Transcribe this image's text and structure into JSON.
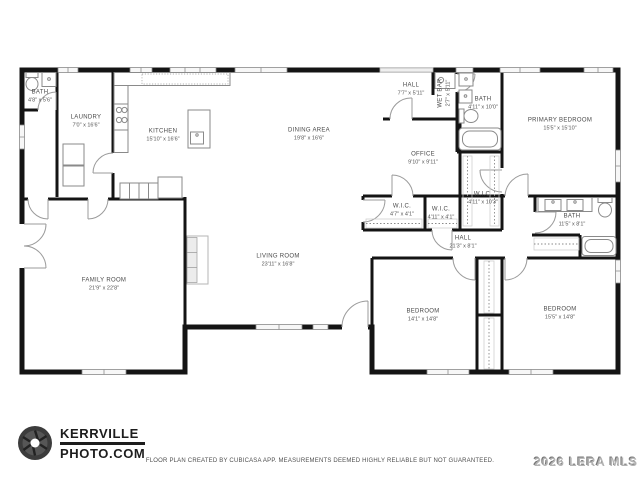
{
  "rooms": {
    "bath_entry": {
      "name": "BATH",
      "dims": "4'8\" x 5'6\""
    },
    "laundry": {
      "name": "LAUNDRY",
      "dims": "7'0\" x 16'6\""
    },
    "kitchen": {
      "name": "KITCHEN",
      "dims": "15'10\" x 16'6\""
    },
    "dining": {
      "name": "DINING AREA",
      "dims": "19'8\" x 16'6\""
    },
    "hall_upper": {
      "name": "HALL",
      "dims": "7'7\" x 5'11\""
    },
    "wet_bar": {
      "name": "WET BAR",
      "dims": "2'7\" x 5'11\""
    },
    "bath_primary": {
      "name": "BATH",
      "dims": "4'11\" x 10'0\""
    },
    "primary_bedroom": {
      "name": "PRIMARY BEDROOM",
      "dims": "15'5\" x 15'10\""
    },
    "office": {
      "name": "OFFICE",
      "dims": "9'10\" x 9'11\""
    },
    "wic_a": {
      "name": "W.I.C.",
      "dims": "4'7\" x 4'1\""
    },
    "wic_b": {
      "name": "W.I.C.",
      "dims": "4'11\" x 4'1\""
    },
    "wic_primary": {
      "name": "W.I.C.",
      "dims": "4'11\" x 10'3\""
    },
    "bath_hall": {
      "name": "BATH",
      "dims": "11'5\" x 8'1\""
    },
    "hall_lower": {
      "name": "HALL",
      "dims": "21'3\" x 8'1\""
    },
    "family_room": {
      "name": "FAMILY ROOM",
      "dims": "21'9\" x 22'8\""
    },
    "living_room": {
      "name": "LIVING ROOM",
      "dims": "23'11\" x 16'8\""
    },
    "bedroom_a": {
      "name": "BEDROOM",
      "dims": "14'1\" x 14'8\""
    },
    "bedroom_b": {
      "name": "BEDROOM",
      "dims": "15'5\" x 14'8\""
    }
  },
  "branding": {
    "logo_line1": "KERRVILLE",
    "logo_line2": "PHOTO.COM",
    "logo_icon": "camera-aperture-icon"
  },
  "footer": {
    "disclaimer": "FLOOR PLAN CREATED BY CUBICASA APP. MEASUREMENTS DEEMED HIGHLY RELIABLE BUT NOT GUARANTEED."
  },
  "watermark": "2026 LERA MLS",
  "colors": {
    "wall": "#141414",
    "door_arc": "#9b9b9b",
    "window_fill": "#f7f7f7",
    "fixture_stroke": "#8a8a8a",
    "label_text": "#4a4a4a",
    "logo_text": "#1d1d1d",
    "watermark_text": "#b3b3b3"
  }
}
